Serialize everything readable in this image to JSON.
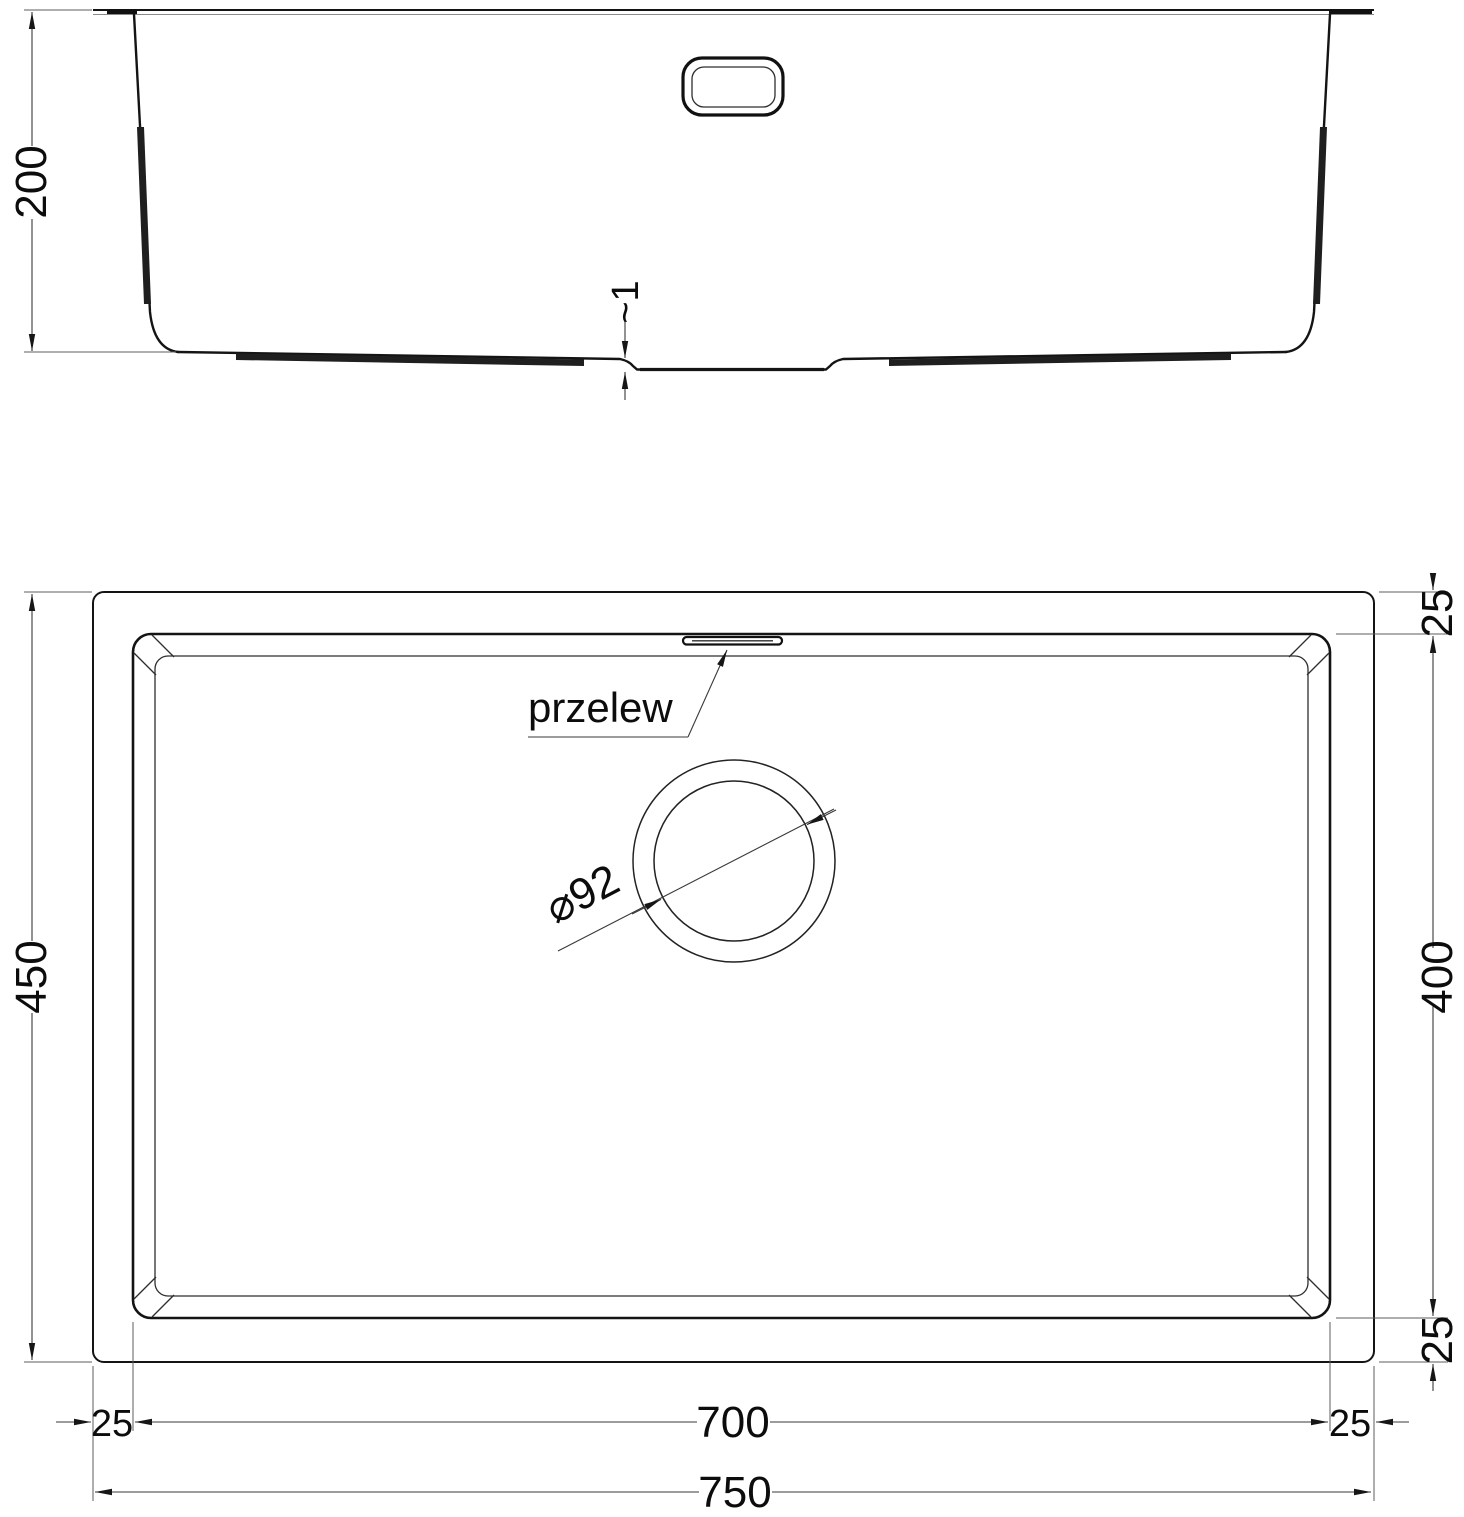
{
  "page": {
    "background": "#ffffff",
    "line_color": "#141414"
  },
  "drawing": {
    "kind": "undermount-sink-technical-drawing",
    "units": "mm",
    "side": {
      "depth_label": "200",
      "floor_step_label": "~1"
    },
    "plan": {
      "overall_depth_label": "450",
      "bowl_depth_label": "400",
      "rim_top_right_label": "25",
      "rim_bottom_right_label": "25",
      "rim_left_label": "25",
      "rim_right_label": "25",
      "bowl_width_label": "700",
      "overall_width_label": "750",
      "overflow_label": "przelew",
      "drain_diameter_label": "⌀92"
    },
    "dimensions_mm": {
      "overall_width": 750,
      "overall_depth": 450,
      "bowl_width": 700,
      "bowl_depth": 400,
      "bowl_height": 200,
      "rim_margin": 25,
      "drain_diameter": 92,
      "floor_step": "~1"
    }
  }
}
